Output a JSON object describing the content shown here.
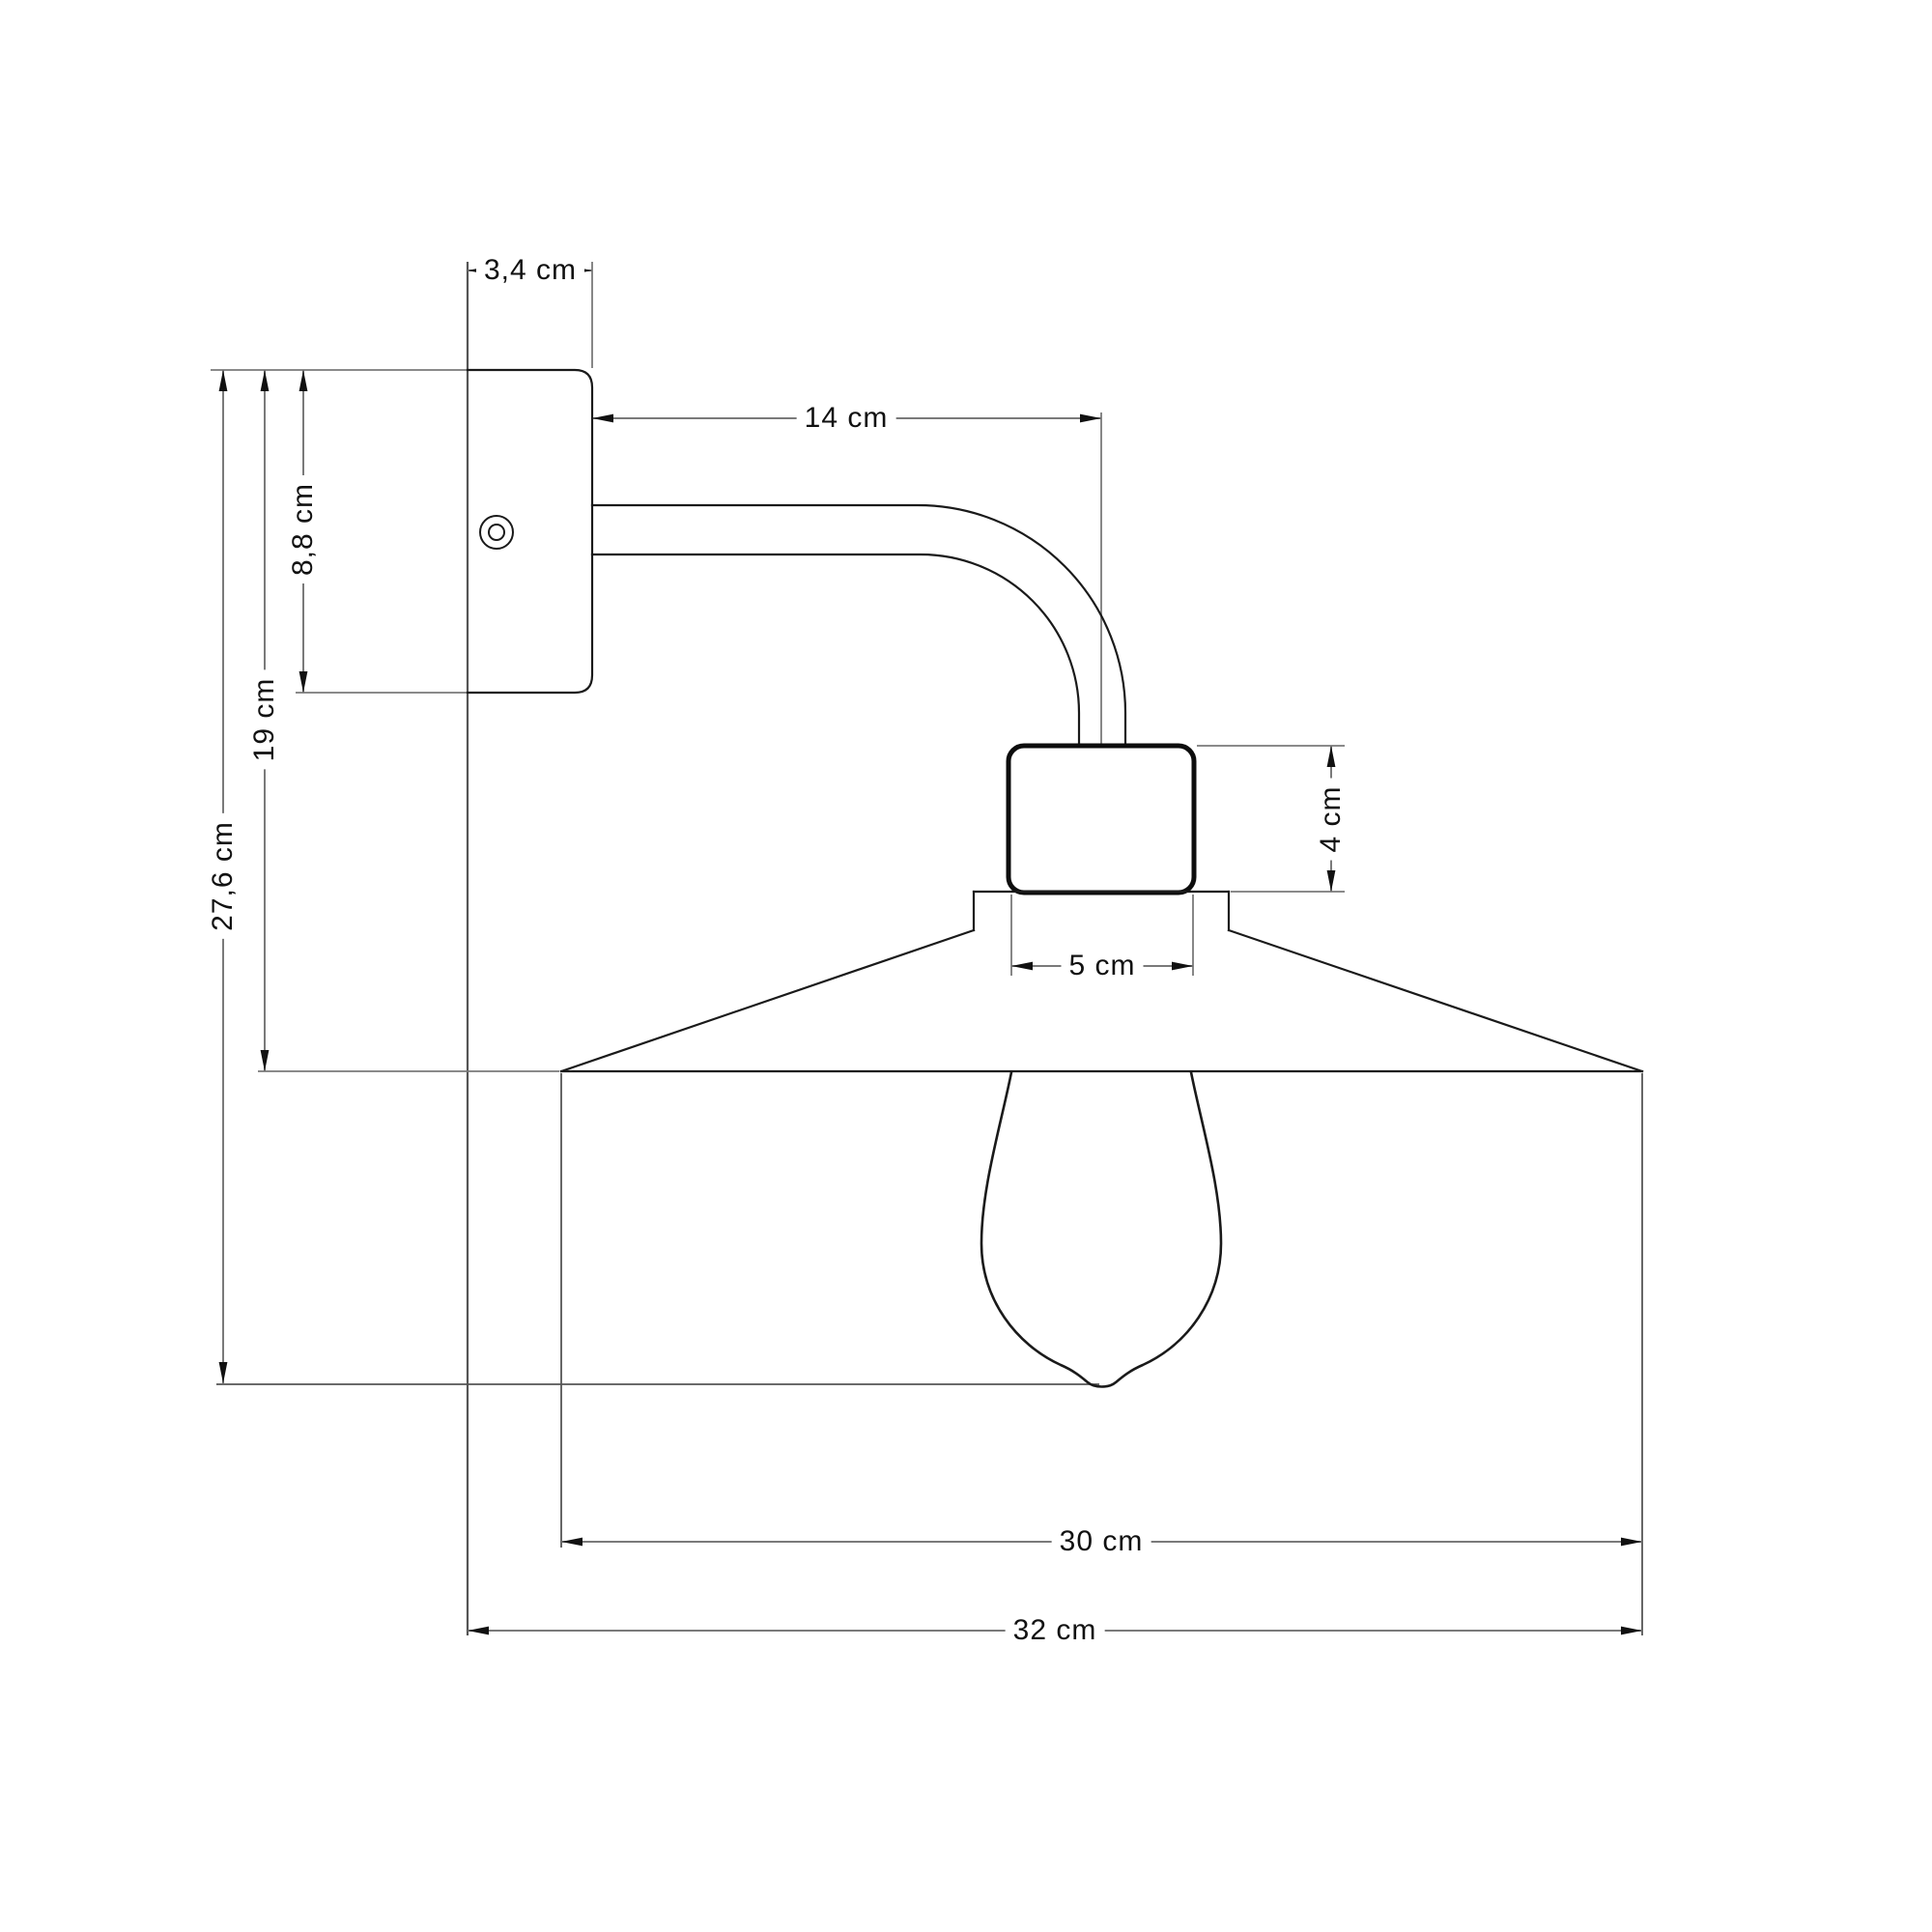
{
  "drawing": {
    "unit": "cm",
    "dimensions": {
      "plate_depth": "3,4 cm",
      "arm_length": "14 cm",
      "plate_height": "8,8 cm",
      "plate_to_shade_height": "19 cm",
      "total_height": "27,6 cm",
      "socket_height": "4 cm",
      "socket_diameter": "5 cm",
      "shade_diameter": "30 cm",
      "total_depth": "32 cm"
    },
    "colors": {
      "background": "#ffffff",
      "outline": "#1a1a1a",
      "dimension_line": "#7a7a7a",
      "reference_line": "#555555",
      "arrow": "#111111",
      "text": "#111111"
    }
  }
}
